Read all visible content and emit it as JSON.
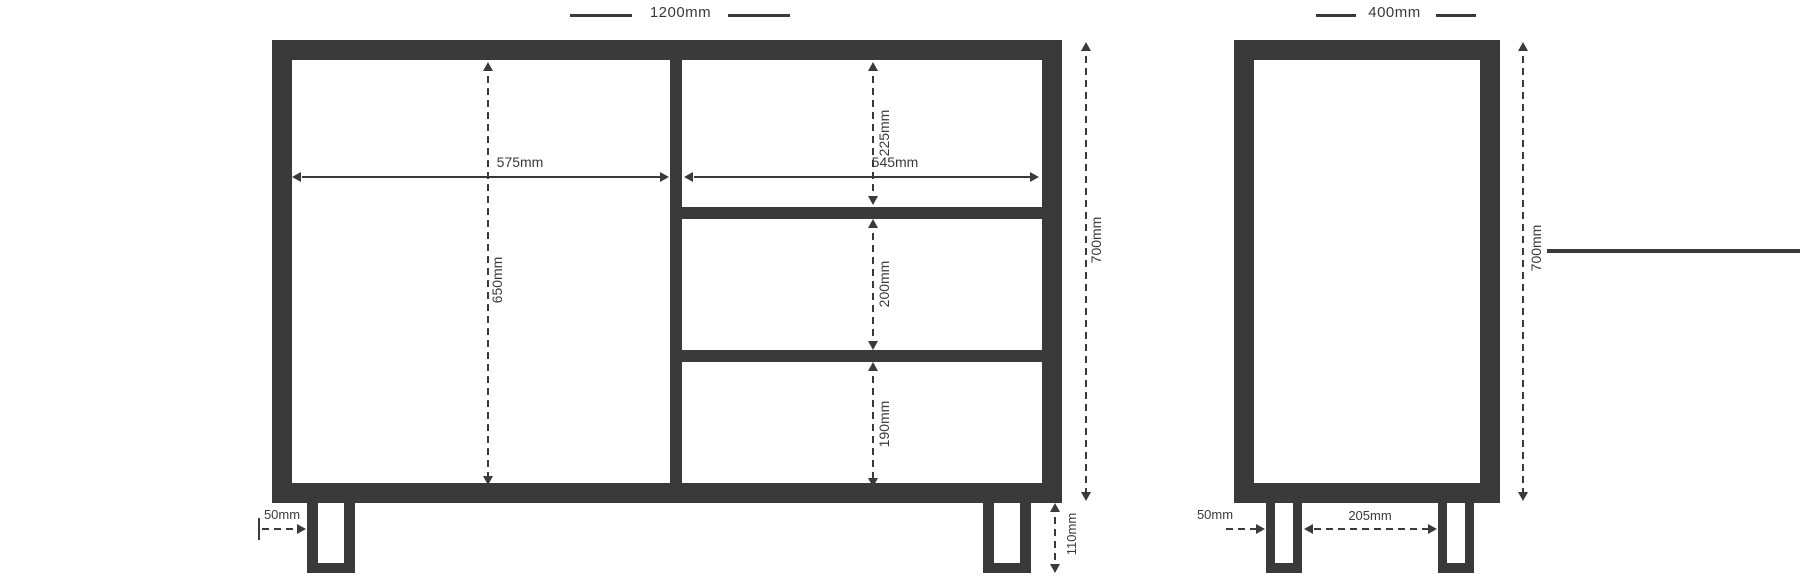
{
  "units": "mm",
  "colors": {
    "line": "#3a3a3a",
    "background": "#ffffff"
  },
  "front": {
    "overall_width": "1200mm",
    "door_width": "575mm",
    "drawer_width": "545mm",
    "height": "700mm",
    "door_height": "650mm",
    "drawer_1_height": "225mm",
    "drawer_2_height": "200mm",
    "drawer_3_height": "190mm",
    "leg_height": "110mm",
    "leg_inset": "50mm"
  },
  "side": {
    "depth": "400mm",
    "height": "700mm",
    "leg_inset": "50mm",
    "leg_spacing": "205mm"
  }
}
